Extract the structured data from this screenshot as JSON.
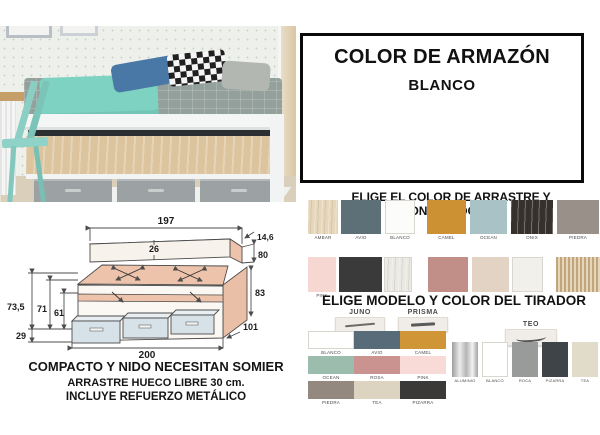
{
  "armazon": {
    "title": "COLOR DE ARMAZÓN",
    "value": "BLANCO"
  },
  "arrastre": {
    "heading": "ELIGE EL COLOR DE ARRASTRE Y CONTENEDORES",
    "row1": [
      {
        "label": "AMBAR",
        "color": "#e6d7bb",
        "texture": "wood"
      },
      {
        "label": "AVIO",
        "color": "#5d7077",
        "texture": "plain"
      },
      {
        "label": "BLANCO",
        "color": "#fcfcfb",
        "texture": "plain"
      },
      {
        "label": "CAMEL",
        "color": "#cc9133",
        "texture": "plain"
      },
      {
        "label": "OCEAN",
        "color": "#a8c2c6",
        "texture": "plain"
      },
      {
        "label": "ONIX",
        "color": "#37322e",
        "texture": "wood"
      },
      {
        "label": "PIEDRA",
        "color": "#99908a",
        "texture": "plain"
      }
    ],
    "row2": [
      {
        "label": "PINK",
        "color": "#f7d7d1",
        "texture": "plain"
      },
      {
        "label": "",
        "color": "#3a3a3a",
        "texture": "plain"
      },
      {
        "label": "",
        "color": "#ebe9e3",
        "texture": "wood"
      },
      {
        "label": "",
        "color": "#c28f88",
        "texture": "plain"
      },
      {
        "label": "",
        "color": "#e2d3c5",
        "texture": "plain"
      },
      {
        "label": "",
        "color": "#f1f0ec",
        "texture": "plain"
      },
      {
        "label": "",
        "color": "#dcc9a4",
        "texture": "stripes"
      }
    ]
  },
  "tirador": {
    "heading": "ELIGE MODELO Y COLOR DEL TIRADOR",
    "models": [
      {
        "name": "JUNO"
      },
      {
        "name": "PRISMA"
      },
      {
        "name": "TEO"
      }
    ],
    "juno_prisma_colors": [
      {
        "label": "BLANCO",
        "color": "#ffffff"
      },
      {
        "label": "AVIO",
        "color": "#576b79"
      },
      {
        "label": "CAMEL",
        "color": "#d09536"
      },
      {
        "label": "OCEAN",
        "color": "#9cbcae"
      },
      {
        "label": "ROSA",
        "color": "#ca938f"
      },
      {
        "label": "PINK",
        "color": "#f8dbd6"
      },
      {
        "label": "PIEDRA",
        "color": "#93897e"
      },
      {
        "label": "TEA",
        "color": "#ddd3c1"
      },
      {
        "label": "PIZARRA",
        "color": "#3b3937"
      }
    ],
    "teo_colors": [
      {
        "label": "ALUMINIO",
        "color": "#c6c6c6",
        "texture": "metal"
      },
      {
        "label": "BLANCO",
        "color": "#ffffff",
        "texture": "plain"
      },
      {
        "label": "ROCA",
        "color": "#999b9a",
        "texture": "plain"
      },
      {
        "label": "PIZARRA",
        "color": "#3e4447",
        "texture": "plain"
      },
      {
        "label": "TEA",
        "color": "#e1dbca",
        "texture": "plain"
      }
    ]
  },
  "diagram": {
    "d197": "197",
    "d26": "26",
    "d146": "14,6",
    "d80": "80",
    "d735": "73,5",
    "d71": "71",
    "d61": "61",
    "d29": "29",
    "d83": "83",
    "d101": "101",
    "d200": "200",
    "notes": {
      "line1": "COMPACTO Y NIDO NECESITAN SOMIER",
      "line2": "ARRASTRE HUECO LIBRE 30 cm.",
      "line3": "INCLUYE REFUERZO METÁLICO"
    }
  }
}
